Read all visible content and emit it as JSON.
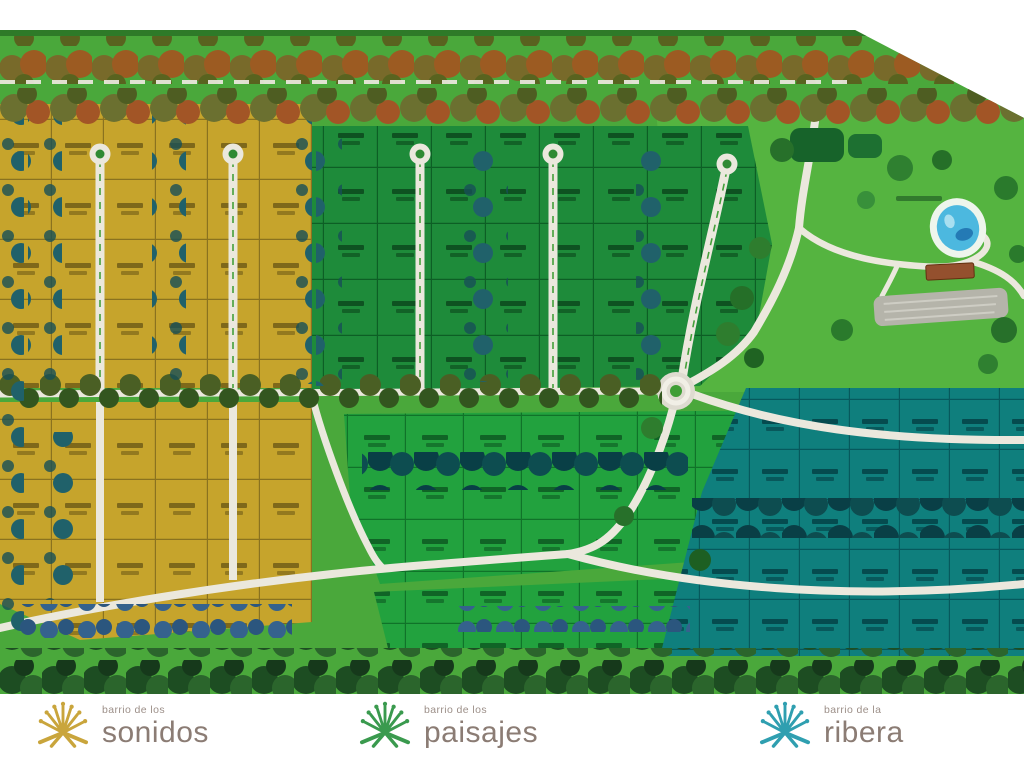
{
  "canvas": {
    "width": 1024,
    "height": 768,
    "background": "#ffffff"
  },
  "map": {
    "grass_color": "#4aa83b",
    "park_grass_color": "#55b440",
    "road_color": "#ebe8dd",
    "pond_color": "#4cb8df",
    "districts": [
      {
        "id": "sonidos",
        "label": "barrio de los sonidos",
        "lot_color": "#c6a42c"
      },
      {
        "id": "paisajes",
        "label": "barrio de los paisajes",
        "lot_color": "#1e8b3a"
      },
      {
        "id": "ribera",
        "label": "barrio de la ribera",
        "lot_color": "#0f7f7d"
      }
    ]
  },
  "logos": [
    {
      "prefix": "barrio de los",
      "name": "sonidos",
      "icon_color": "#c9a53c"
    },
    {
      "prefix": "barrio de los",
      "name": "paisajes",
      "icon_color": "#3a9a4e"
    },
    {
      "prefix": "barrio de la",
      "name": "ribera",
      "icon_color": "#2f9fb0"
    }
  ]
}
